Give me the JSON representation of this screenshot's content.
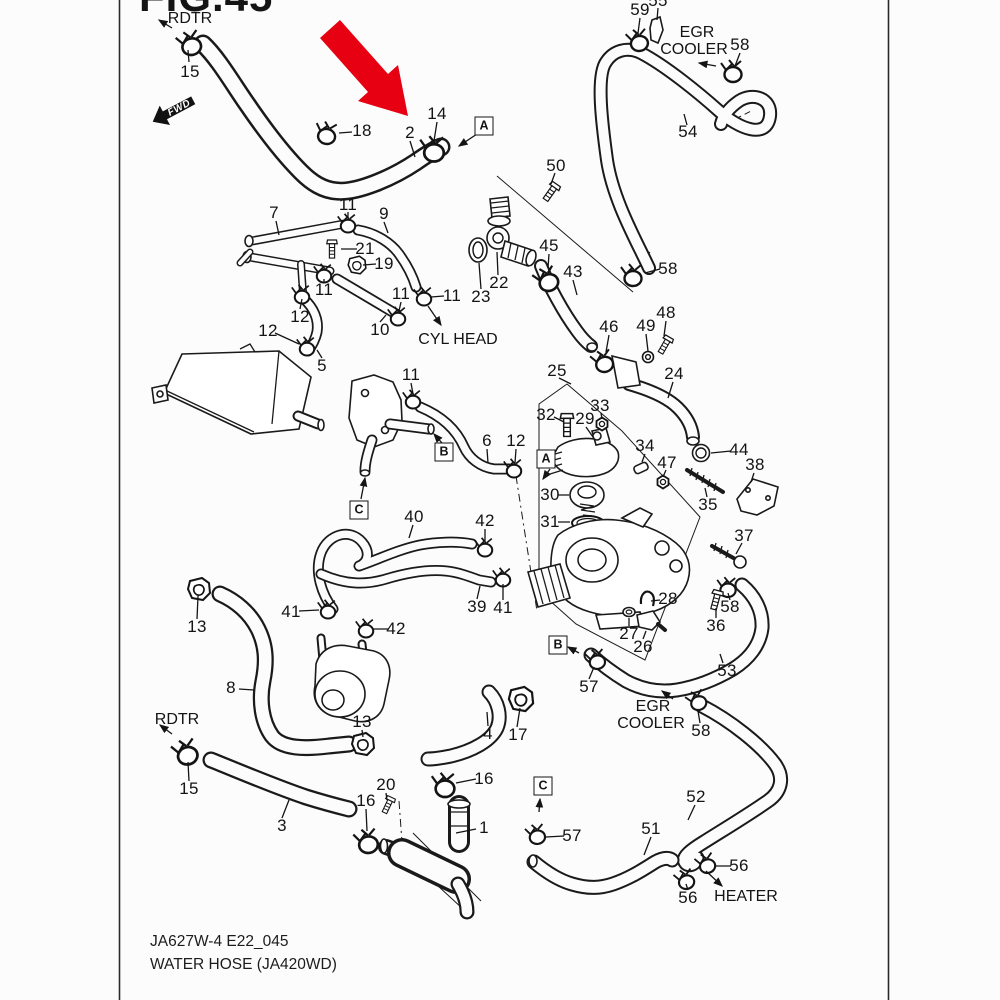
{
  "figure": {
    "title": "FIG.45",
    "code": "JA627W-4 E22_045",
    "name": "WATER HOSE (JA420WD)"
  },
  "colors": {
    "ink": "#1a1a1a",
    "background": "#fcfcfc",
    "highlight_arrow": "#e60012"
  },
  "fwd_badge": {
    "label": "FWD"
  },
  "annotations": [
    {
      "id": "rdtr-top-label",
      "text": "RDTR",
      "x": 190,
      "y": 19
    },
    {
      "id": "egr-cooler-top-1",
      "text": "EGR",
      "x": 697,
      "y": 33
    },
    {
      "id": "egr-cooler-top-2",
      "text": "COOLER",
      "x": 694,
      "y": 50
    },
    {
      "id": "cyl-head-label",
      "text": "CYL HEAD",
      "x": 458,
      "y": 340
    },
    {
      "id": "egr-cooler-bot-1",
      "text": "EGR",
      "x": 653,
      "y": 707
    },
    {
      "id": "egr-cooler-bot-2",
      "text": "COOLER",
      "x": 651,
      "y": 724
    },
    {
      "id": "rdtr-bottom-label",
      "text": "RDTR",
      "x": 177,
      "y": 720
    },
    {
      "id": "heater-label",
      "text": "HEATER",
      "x": 746,
      "y": 897
    }
  ],
  "ref_boxes": [
    {
      "letter": "A",
      "x": 484,
      "y": 126
    },
    {
      "letter": "A",
      "x": 546,
      "y": 459
    },
    {
      "letter": "B",
      "x": 444,
      "y": 452
    },
    {
      "letter": "B",
      "x": 558,
      "y": 645
    },
    {
      "letter": "C",
      "x": 359,
      "y": 510
    },
    {
      "letter": "C",
      "x": 543,
      "y": 786
    }
  ],
  "callouts": [
    {
      "t": "15",
      "x": 190,
      "y": 72
    },
    {
      "t": "18",
      "x": 362,
      "y": 131
    },
    {
      "t": "2",
      "x": 410,
      "y": 133
    },
    {
      "t": "14",
      "x": 437,
      "y": 114
    },
    {
      "t": "59",
      "x": 640,
      "y": 10
    },
    {
      "t": "55",
      "x": 658,
      "y": 1
    },
    {
      "t": "58",
      "x": 740,
      "y": 45
    },
    {
      "t": "54",
      "x": 688,
      "y": 132
    },
    {
      "t": "50",
      "x": 556,
      "y": 166
    },
    {
      "t": "7",
      "x": 274,
      "y": 213
    },
    {
      "t": "11",
      "x": 348,
      "y": 205
    },
    {
      "t": "9",
      "x": 384,
      "y": 214
    },
    {
      "t": "21",
      "x": 365,
      "y": 249
    },
    {
      "t": "19",
      "x": 384,
      "y": 264
    },
    {
      "t": "11",
      "x": 324,
      "y": 290
    },
    {
      "t": "12",
      "x": 300,
      "y": 317
    },
    {
      "t": "12",
      "x": 268,
      "y": 331
    },
    {
      "t": "10",
      "x": 380,
      "y": 330
    },
    {
      "t": "11",
      "x": 401,
      "y": 294
    },
    {
      "t": "11",
      "x": 452,
      "y": 296
    },
    {
      "t": "5",
      "x": 322,
      "y": 366
    },
    {
      "t": "22",
      "x": 499,
      "y": 283
    },
    {
      "t": "23",
      "x": 481,
      "y": 297
    },
    {
      "t": "45",
      "x": 549,
      "y": 246
    },
    {
      "t": "43",
      "x": 573,
      "y": 272
    },
    {
      "t": "58",
      "x": 668,
      "y": 269
    },
    {
      "t": "46",
      "x": 609,
      "y": 327
    },
    {
      "t": "49",
      "x": 646,
      "y": 326
    },
    {
      "t": "48",
      "x": 666,
      "y": 313
    },
    {
      "t": "24",
      "x": 674,
      "y": 374
    },
    {
      "t": "25",
      "x": 557,
      "y": 371
    },
    {
      "t": "32",
      "x": 546,
      "y": 415
    },
    {
      "t": "29",
      "x": 585,
      "y": 419
    },
    {
      "t": "33",
      "x": 600,
      "y": 406
    },
    {
      "t": "30",
      "x": 550,
      "y": 495
    },
    {
      "t": "31",
      "x": 550,
      "y": 522
    },
    {
      "t": "34",
      "x": 645,
      "y": 446
    },
    {
      "t": "47",
      "x": 667,
      "y": 463
    },
    {
      "t": "44",
      "x": 739,
      "y": 450
    },
    {
      "t": "38",
      "x": 755,
      "y": 465
    },
    {
      "t": "35",
      "x": 708,
      "y": 505
    },
    {
      "t": "37",
      "x": 744,
      "y": 536
    },
    {
      "t": "11",
      "x": 411,
      "y": 375
    },
    {
      "t": "6",
      "x": 487,
      "y": 441
    },
    {
      "t": "12",
      "x": 516,
      "y": 441
    },
    {
      "t": "40",
      "x": 414,
      "y": 517
    },
    {
      "t": "42",
      "x": 485,
      "y": 521
    },
    {
      "t": "41",
      "x": 291,
      "y": 612
    },
    {
      "t": "42",
      "x": 396,
      "y": 629
    },
    {
      "t": "39",
      "x": 477,
      "y": 607
    },
    {
      "t": "41",
      "x": 503,
      "y": 608
    },
    {
      "t": "13",
      "x": 197,
      "y": 627
    },
    {
      "t": "8",
      "x": 231,
      "y": 688
    },
    {
      "t": "13",
      "x": 362,
      "y": 722
    },
    {
      "t": "15",
      "x": 189,
      "y": 789
    },
    {
      "t": "3",
      "x": 282,
      "y": 826
    },
    {
      "t": "16",
      "x": 366,
      "y": 801
    },
    {
      "t": "20",
      "x": 386,
      "y": 785
    },
    {
      "t": "16",
      "x": 484,
      "y": 779
    },
    {
      "t": "4",
      "x": 488,
      "y": 734
    },
    {
      "t": "17",
      "x": 518,
      "y": 735
    },
    {
      "t": "1",
      "x": 484,
      "y": 828
    },
    {
      "t": "28",
      "x": 668,
      "y": 599
    },
    {
      "t": "27",
      "x": 629,
      "y": 634
    },
    {
      "t": "26",
      "x": 643,
      "y": 647
    },
    {
      "t": "36",
      "x": 716,
      "y": 626
    },
    {
      "t": "58",
      "x": 730,
      "y": 607
    },
    {
      "t": "57",
      "x": 589,
      "y": 687
    },
    {
      "t": "53",
      "x": 727,
      "y": 671
    },
    {
      "t": "58",
      "x": 701,
      "y": 731
    },
    {
      "t": "57",
      "x": 572,
      "y": 836
    },
    {
      "t": "51",
      "x": 651,
      "y": 829
    },
    {
      "t": "52",
      "x": 696,
      "y": 797
    },
    {
      "t": "56",
      "x": 688,
      "y": 898
    },
    {
      "t": "56",
      "x": 739,
      "y": 866
    }
  ]
}
